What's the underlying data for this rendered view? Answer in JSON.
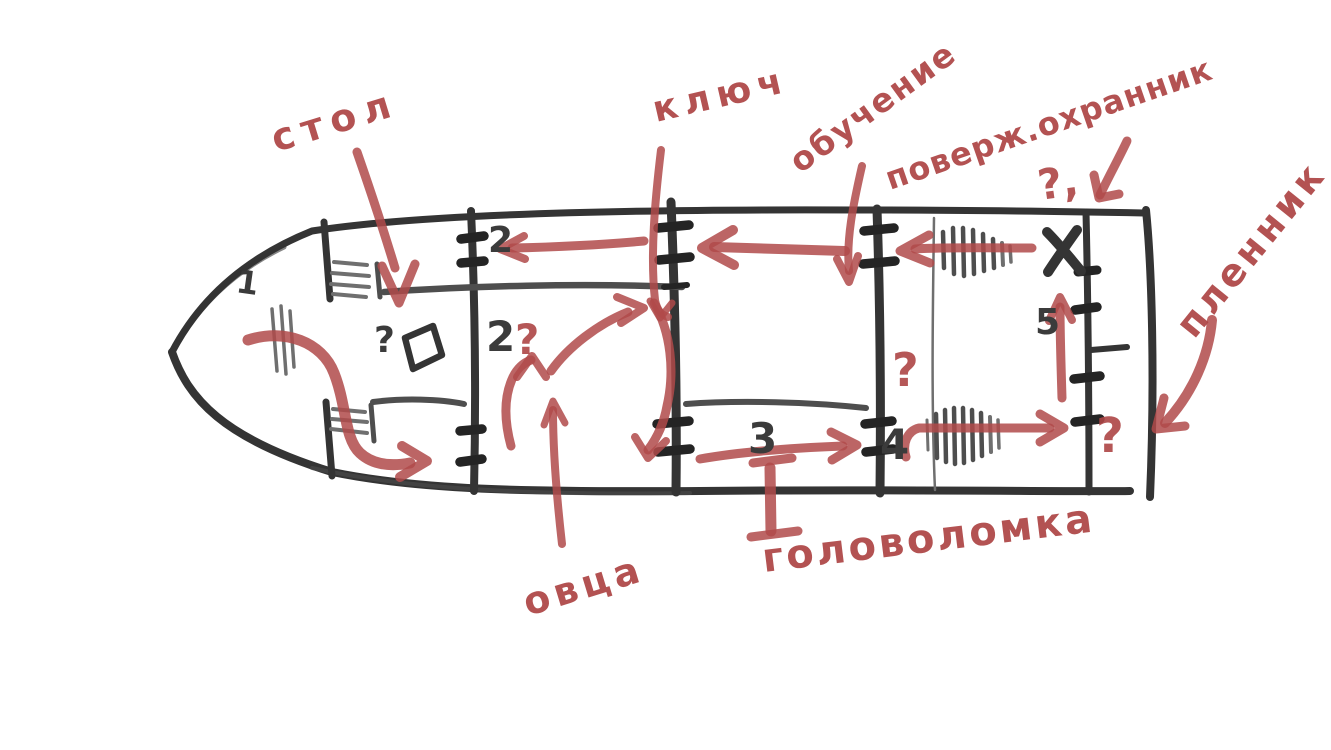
{
  "canvas": {
    "background": "#ffffff"
  },
  "colors": {
    "ink": "#343434",
    "ink_soft": "#4e4e4e",
    "ink_light": "#6f6f6f",
    "annotation_red": "#b04a4a"
  },
  "diagram_type": "hand-drawn ship deck plan with red route annotations",
  "labels": {
    "table": "стол",
    "key": "ключ",
    "training": "обучение",
    "defeated_guard": "поверж.охранник",
    "entry_question": "?,",
    "prisoner": "пленник",
    "sheep": "овца",
    "puzzle": "головоломка"
  },
  "rooms": {
    "bow": "1",
    "corridor": "2",
    "hold": "2",
    "room3": "3",
    "room4": "4",
    "room5": "5"
  },
  "marks": {
    "hold_question": "?",
    "table_question": "?",
    "room4_question": "?",
    "stern_question": "?"
  }
}
